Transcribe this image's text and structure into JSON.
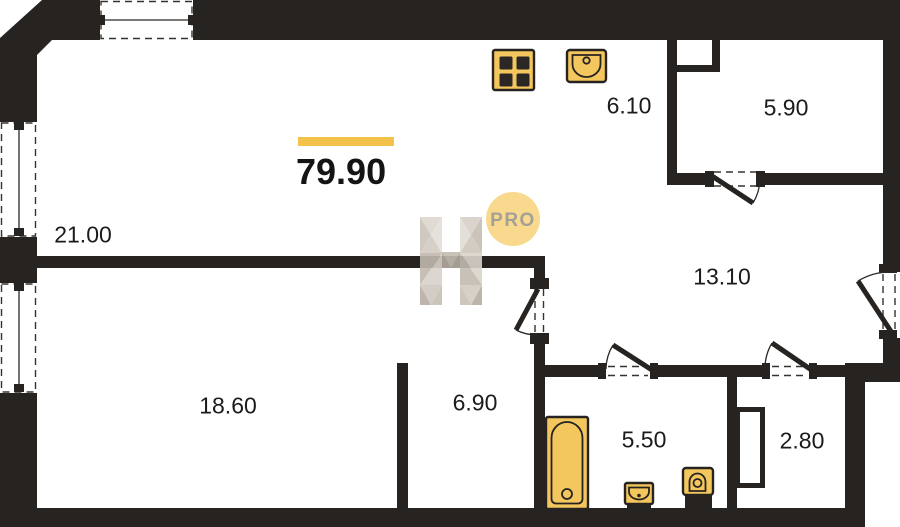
{
  "floorplan": {
    "total_area": "79.90",
    "badge_text": "PRO",
    "room_areas": {
      "living": "21.00",
      "kitchen": "6.10",
      "storage": "5.90",
      "hallway": "13.10",
      "bedroom": "18.60",
      "cabinet": "6.90",
      "bathroom": "5.50",
      "wc": "2.80"
    },
    "colors": {
      "wall": "#262321",
      "fixture_fill": "#f4c75e",
      "accent_bar": "#f2c24b",
      "badge_bg": "#f8d98d",
      "badge_text_color": "#a5a096",
      "label_color": "#1b1b1b"
    }
  }
}
